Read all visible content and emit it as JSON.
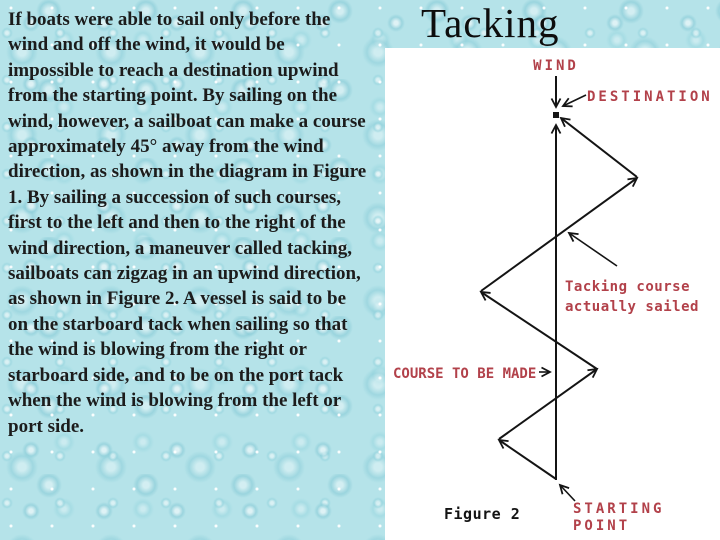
{
  "colors": {
    "slide_bg": "#b5e3e9",
    "panel_bg": "#ffffff",
    "body_text": "#1c1c1c",
    "title_color": "#0d0d0d",
    "label_red": "#b2414a",
    "line_black": "#141414"
  },
  "slide": {
    "title": "Tacking",
    "body_text": "If boats were able to sail only before the wind and off the wind, it would be impossible to reach a destination upwind from the starting point. By sailing on the wind, however, a sailboat can make a course approximately 45° away from the wind direction, as shown in the diagram in Figure 1. By sailing a succession of such courses, first to the left and then to the right of the wind direction, a maneuver called tacking, sailboats can zigzag in an upwind direction, as shown in Figure 2. A vessel is said to be on the starboard tack when sailing so that the wind is blowing from the right or starboard side, and to be on the port tack when the wind is blowing from the left or port side."
  },
  "diagram": {
    "figure_caption": "Figure 2",
    "labels": {
      "wind": "WIND",
      "destination": "DESTINATION",
      "tacking_course_line1": "Tacking course",
      "tacking_course_line2": "actually sailed",
      "course_to_be_made": "COURSE TO BE MADE",
      "starting_point_line1": "STARTING",
      "starting_point_line2": "POINT"
    }
  }
}
